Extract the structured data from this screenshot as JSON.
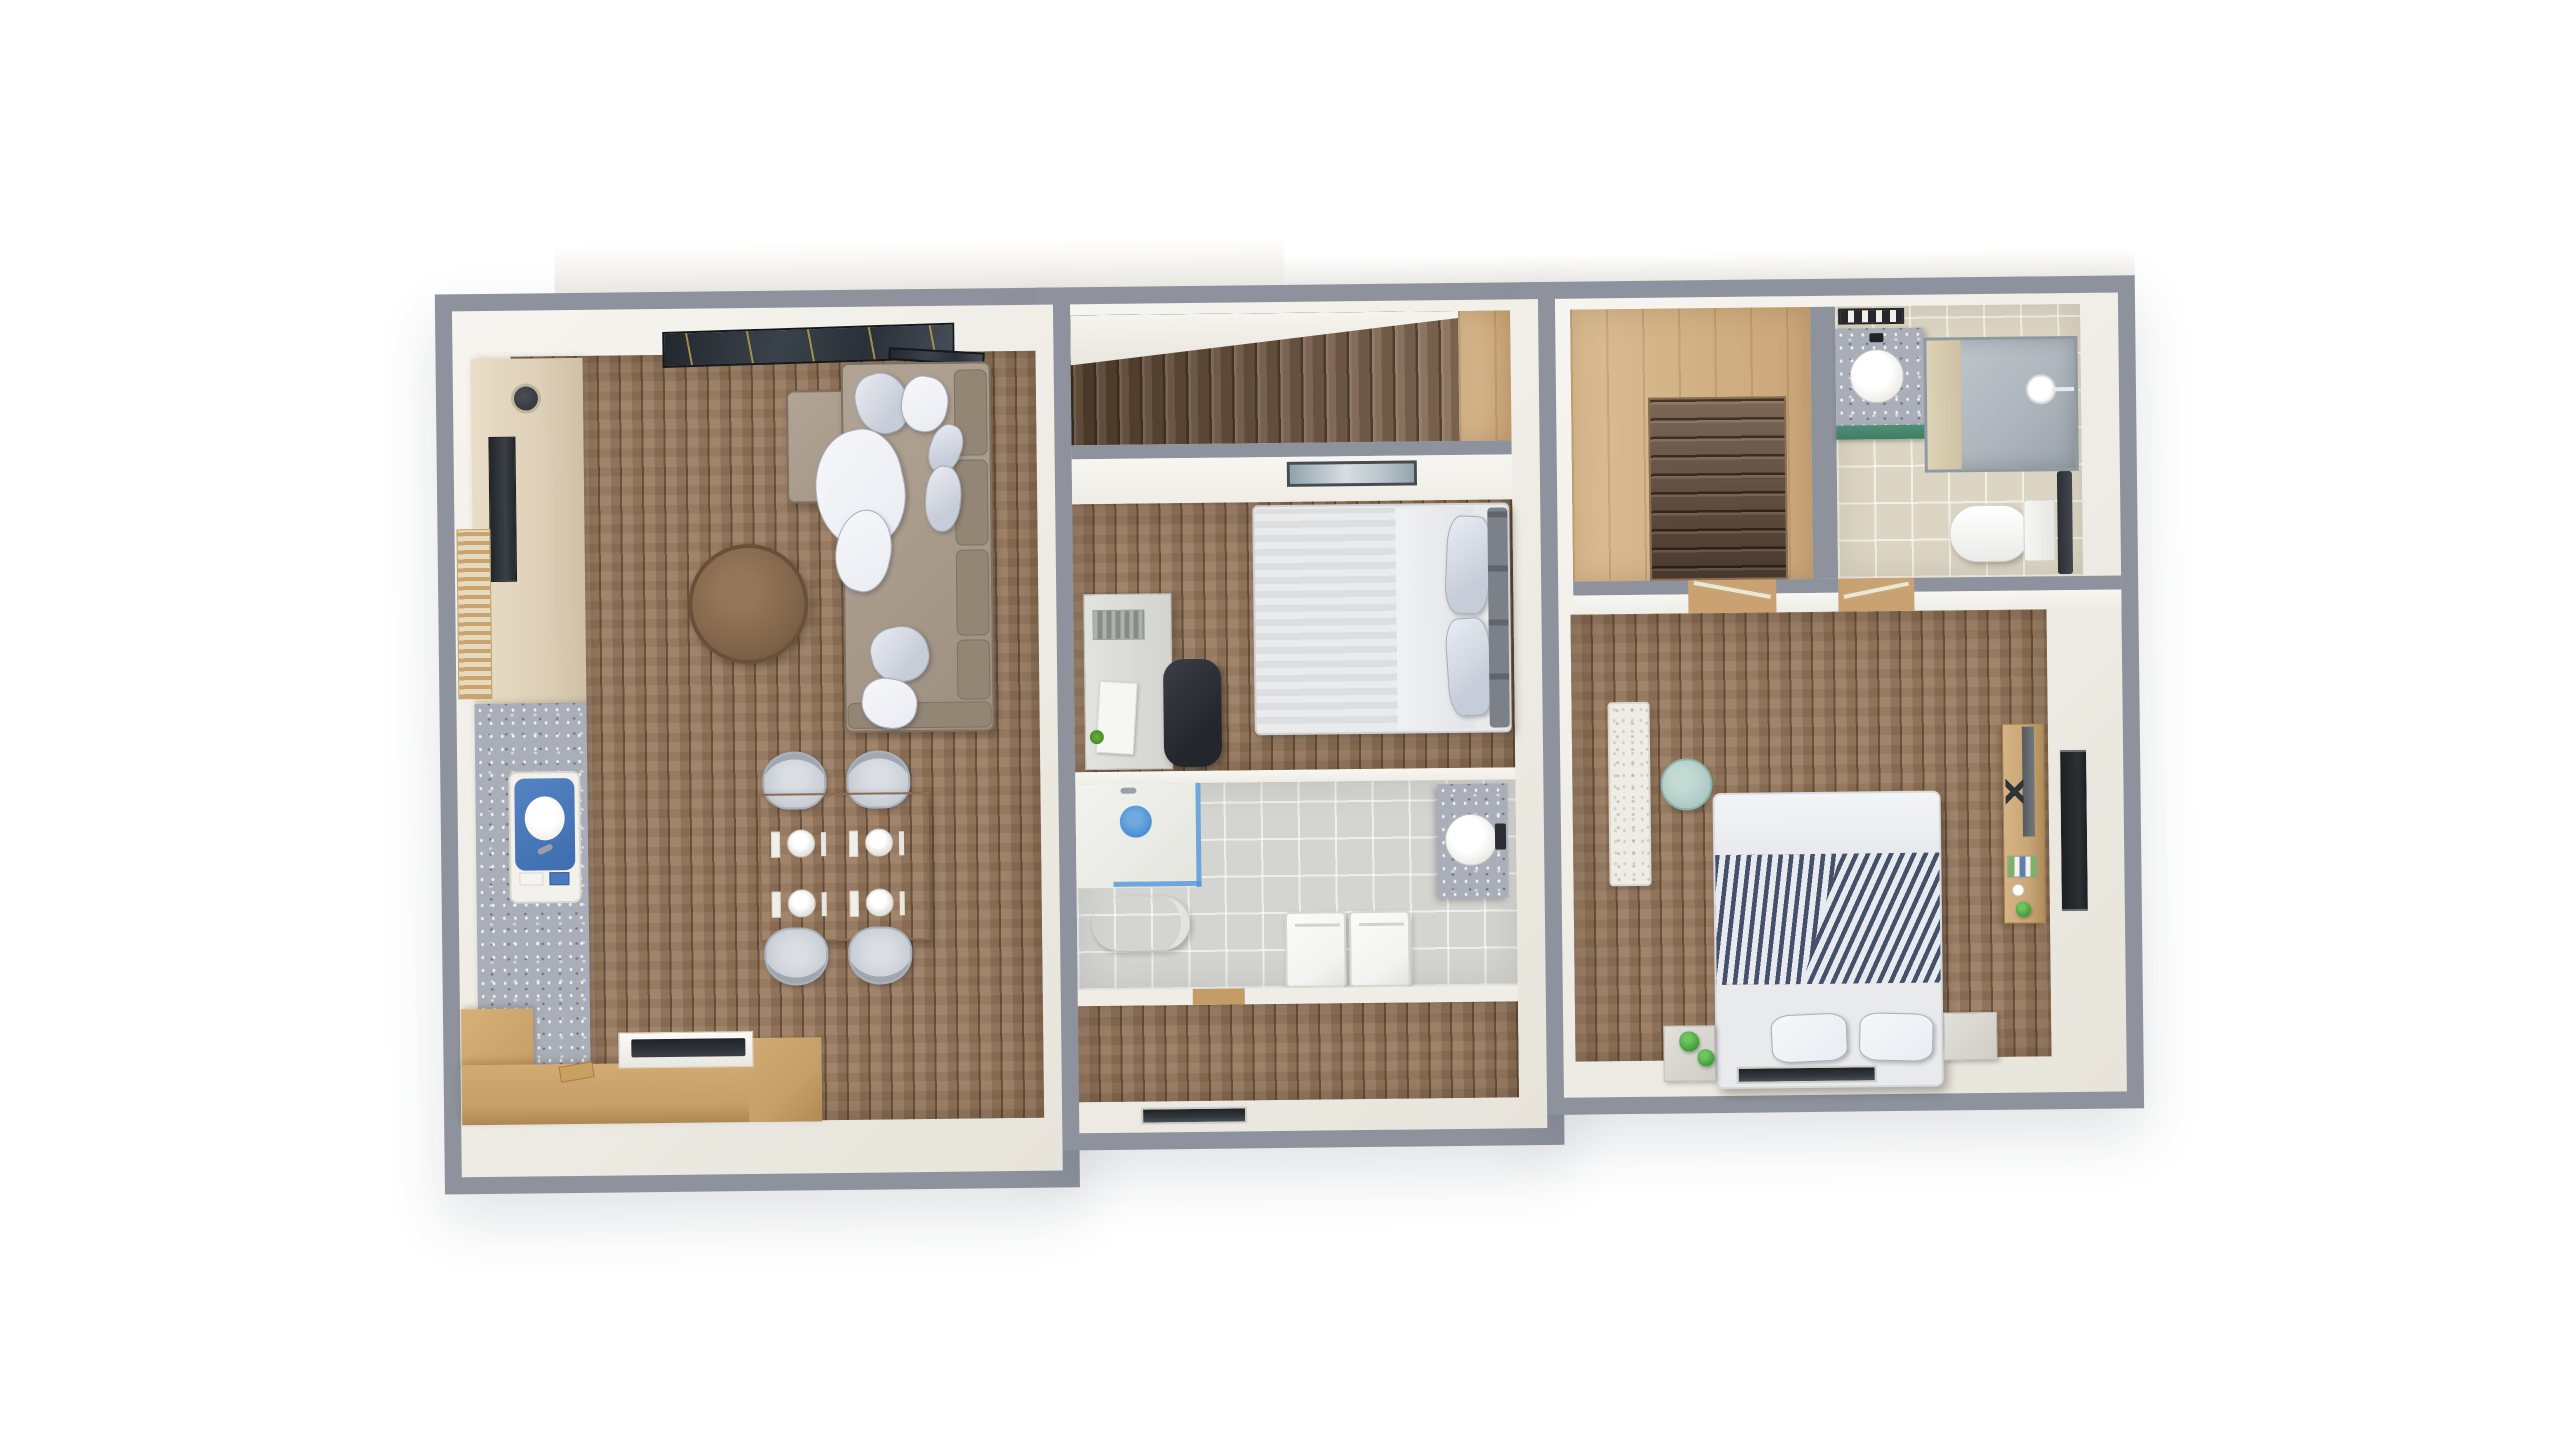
{
  "meta": {
    "title": "apartment-floor-plan-top-down-3d-render",
    "description": "Top-down 3D render of a three-section apartment floor plan on a white background",
    "background_color": "#ffffff",
    "plan_rotation_deg": -0.65
  },
  "colors": {
    "wall_outer": "#8d929c",
    "wall_inner": "#efede6",
    "wood_living": "#96775b",
    "wood_dark": "#76593f",
    "plywood": "#d5b181",
    "tile_gray": "#d4d5d0",
    "tile_beige": "#ddd5c3",
    "marble": "#a9aeb8",
    "terrazzo": "#efece6",
    "cream_cabinet": "#ded0b8",
    "island_wood": "#c59e68",
    "sofa": "#a89a8b",
    "sofa_dark": "#948675",
    "pillow": "#c7cdd8",
    "pillow_light": "#e9ecf1",
    "table_round": "#7d6146",
    "dining_table": "#a38262",
    "chair": "#c7ccd4",
    "sink_blue": "#3e6db0",
    "mat_blue": "#4a8fd2",
    "bed_gray": "#676c76",
    "bed_white": "#e9eaec",
    "headboard": "#7b8089",
    "stripe_navy": "#46506a",
    "mint": "#abc8c3",
    "plant": "#46a23c",
    "green_shelf": "#3f7e65",
    "dark_panel": "#33383e",
    "gold": "#c1a34f",
    "appliance": "#f3f3f1",
    "console_wood": "#c8a677"
  },
  "rooms": [
    {
      "id": "living-area",
      "label": "open living room with kitchen and dining area"
    },
    {
      "id": "stair-hall",
      "label": "staircase hall with wooden steps"
    },
    {
      "id": "bedroom-middle",
      "label": "middle bedroom with double bed and desk"
    },
    {
      "id": "bathroom-middle",
      "label": "middle bathroom with shower, toilet, laundry units and vanity"
    },
    {
      "id": "hallway",
      "label": "lower hallway"
    },
    {
      "id": "stairwell-right",
      "label": "plywood stairwell landing with descending stairs"
    },
    {
      "id": "bathroom-right",
      "label": "upper-right bathroom with vanity, shower and toilet"
    },
    {
      "id": "bedroom-right",
      "label": "right bedroom with striped double bed"
    }
  ],
  "furniture": {
    "living_area": [
      "corner-sofa",
      "throw-pillows",
      "white-throw-blanket",
      "round-coffee-table",
      "dining-table",
      "dining-chairs",
      "place-settings",
      "tv-console",
      "wall-screen",
      "slatted-mat",
      "wall-speaker",
      "marble-counter",
      "blue-kitchen-sink",
      "kitchen-island",
      "cooktop",
      "cutting-boards",
      "skylight-glass"
    ],
    "bedroom_middle": [
      "double-bed-gray-duvet",
      "stacked-pillows",
      "headboard-cushions",
      "desk",
      "desk-papers",
      "pen-tray",
      "office-chair",
      "wall-art"
    ],
    "bathroom_middle": [
      "walk-in-shower",
      "blue-shower-mat",
      "toilet",
      "washer",
      "dryer",
      "marble-vanity",
      "round-basin"
    ],
    "stairwell_right": [
      "wooden-stairs"
    ],
    "bathroom_right": [
      "towel-rack",
      "marble-vanity",
      "round-basin",
      "green-shelf",
      "glass-shower",
      "shower-head",
      "toilet-with-tank",
      "dark-radiator"
    ],
    "bedroom_right": [
      "terrazzo-desk",
      "mint-side-table",
      "double-bed-striped-duvet",
      "bed-pillows",
      "nightstand-left",
      "potted-plants",
      "nightstand-right",
      "wood-media-console",
      "console-screen",
      "wall-niche-shelf",
      "floor-vent"
    ]
  },
  "counts": {
    "dining_chairs": 4,
    "place_settings": 4,
    "stair_hall_treads": 17,
    "stairwell_treads": 10,
    "laundry_units": 2,
    "right_bed_pillows": 2,
    "plants": 2,
    "door_openings_right_section": 2
  }
}
